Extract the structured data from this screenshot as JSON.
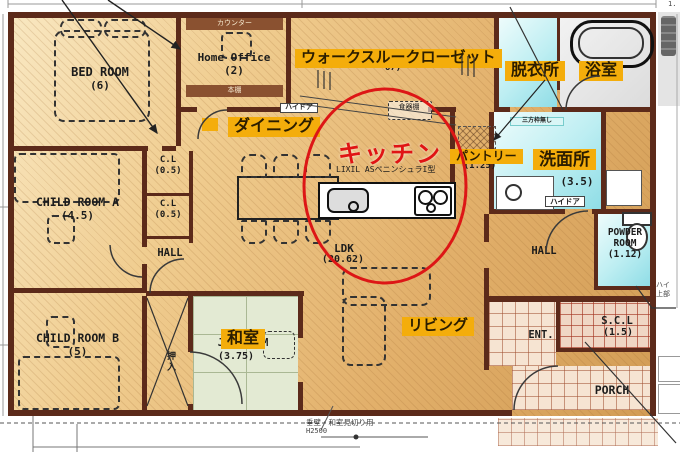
{
  "labels": {
    "walk_through_closet": "ウォークスルークローゼット",
    "dining": "ダイニング",
    "kitchen": "キッチン",
    "pantry": "パントリー",
    "dressing_room": "脱衣所",
    "bathroom": "浴室",
    "washroom": "洗面所",
    "washroom_size": "(3.5)",
    "japanese_room": "和室",
    "living": "リビング"
  },
  "rooms": {
    "bedroom": {
      "name": "BED ROOM",
      "size": "(6)"
    },
    "home_office": {
      "name": "Home Office",
      "size": "(2)"
    },
    "child_a": {
      "name": "CHILD ROOM A",
      "size": "(4.5)"
    },
    "child_b": {
      "name": "CHILD ROOM B",
      "size": "(5)"
    },
    "closet_1": {
      "name": "C.L",
      "size": "(0.5)"
    },
    "closet_2": {
      "name": "C.L",
      "size": "(0.5)"
    },
    "hall_west": "HALL",
    "hall_east": "HALL",
    "jap_room": {
      "name": "JAP ROOM",
      "size": "(3.75)"
    },
    "ldk": {
      "name": "LDK",
      "size": "(20.62)"
    },
    "powder": {
      "line1": "POWDER",
      "line2": "ROOM",
      "size": "(1.12)"
    },
    "scl": {
      "name": "S.C.L",
      "size": "(1.5)"
    },
    "entrance": "ENT.",
    "porch": "PORCH",
    "oshiire": "押入"
  },
  "annotations": {
    "kitchen_model": "LIXIL ASペニンシュラI型",
    "counter": "カウンター",
    "bookshelf": "本棚",
    "dish_shelf": "食器棚",
    "high_door_1": "ハイドア",
    "high_door_2": "ハイドア",
    "frame_note": "三方枠無し",
    "right_note_line1": "ハイ",
    "right_note_line2": "上部",
    "bottom_note": "垂壁・和室見切り用",
    "bottom_note_height": "H2500",
    "wtc_size_partial": "67)",
    "pantry_size_partial": "(1.25)",
    "dim_fragment": "1."
  },
  "colors": {
    "label_bg": "#f4ad0b",
    "kitchen_red": "#e01414",
    "wall": "#5c2a1a",
    "circle_red": "#dd1616"
  }
}
